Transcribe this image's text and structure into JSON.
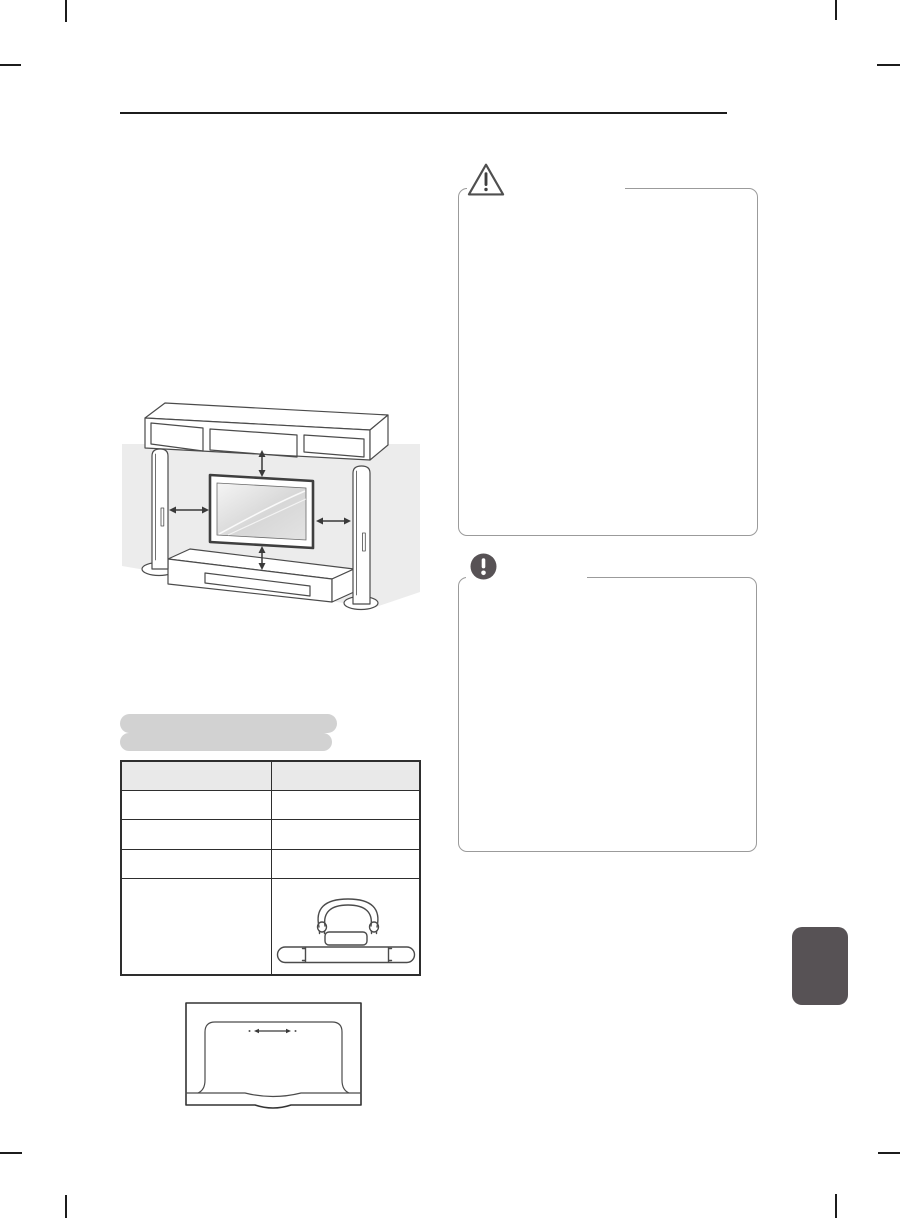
{
  "document": {
    "kind": "tv-owner-manual-page",
    "visible_text": "",
    "heading_redacted_lines": 2
  },
  "colors": {
    "page_bg": "#ffffff",
    "ink": "#1c1c1c",
    "diagram_stroke": "#4b4b4b",
    "wall_fill": "#ececec",
    "panel_border": "#9b9b9b",
    "redaction_fill": "#d2d2d2",
    "table_border": "#2e2e2e",
    "table_header_fill": "#e9e9e9",
    "dark_accent": "#575255",
    "screen_grad_light": "#f5f5f5",
    "screen_grad_dark": "#d7d7d7"
  },
  "icons": {
    "caution": "warning-triangle-icon",
    "note": "exclamation-circle-icon"
  },
  "panels": {
    "caution": {
      "title": "",
      "body": ""
    },
    "note": {
      "title": "",
      "body": ""
    }
  },
  "table": {
    "columns": 2,
    "header": [
      "",
      ""
    ],
    "rows": [
      [
        "",
        ""
      ],
      [
        "",
        ""
      ],
      [
        "",
        ""
      ],
      [
        "",
        "stand-parts-illustration"
      ]
    ]
  },
  "illustrations": {
    "placement_diagram": "tv-between-speakers-shelf-and-console-with-clearance-arrows",
    "stand_parts": "stand-body-bracket-and-base",
    "tv_back": "tv-rear-cover-with-slide-arrow"
  }
}
